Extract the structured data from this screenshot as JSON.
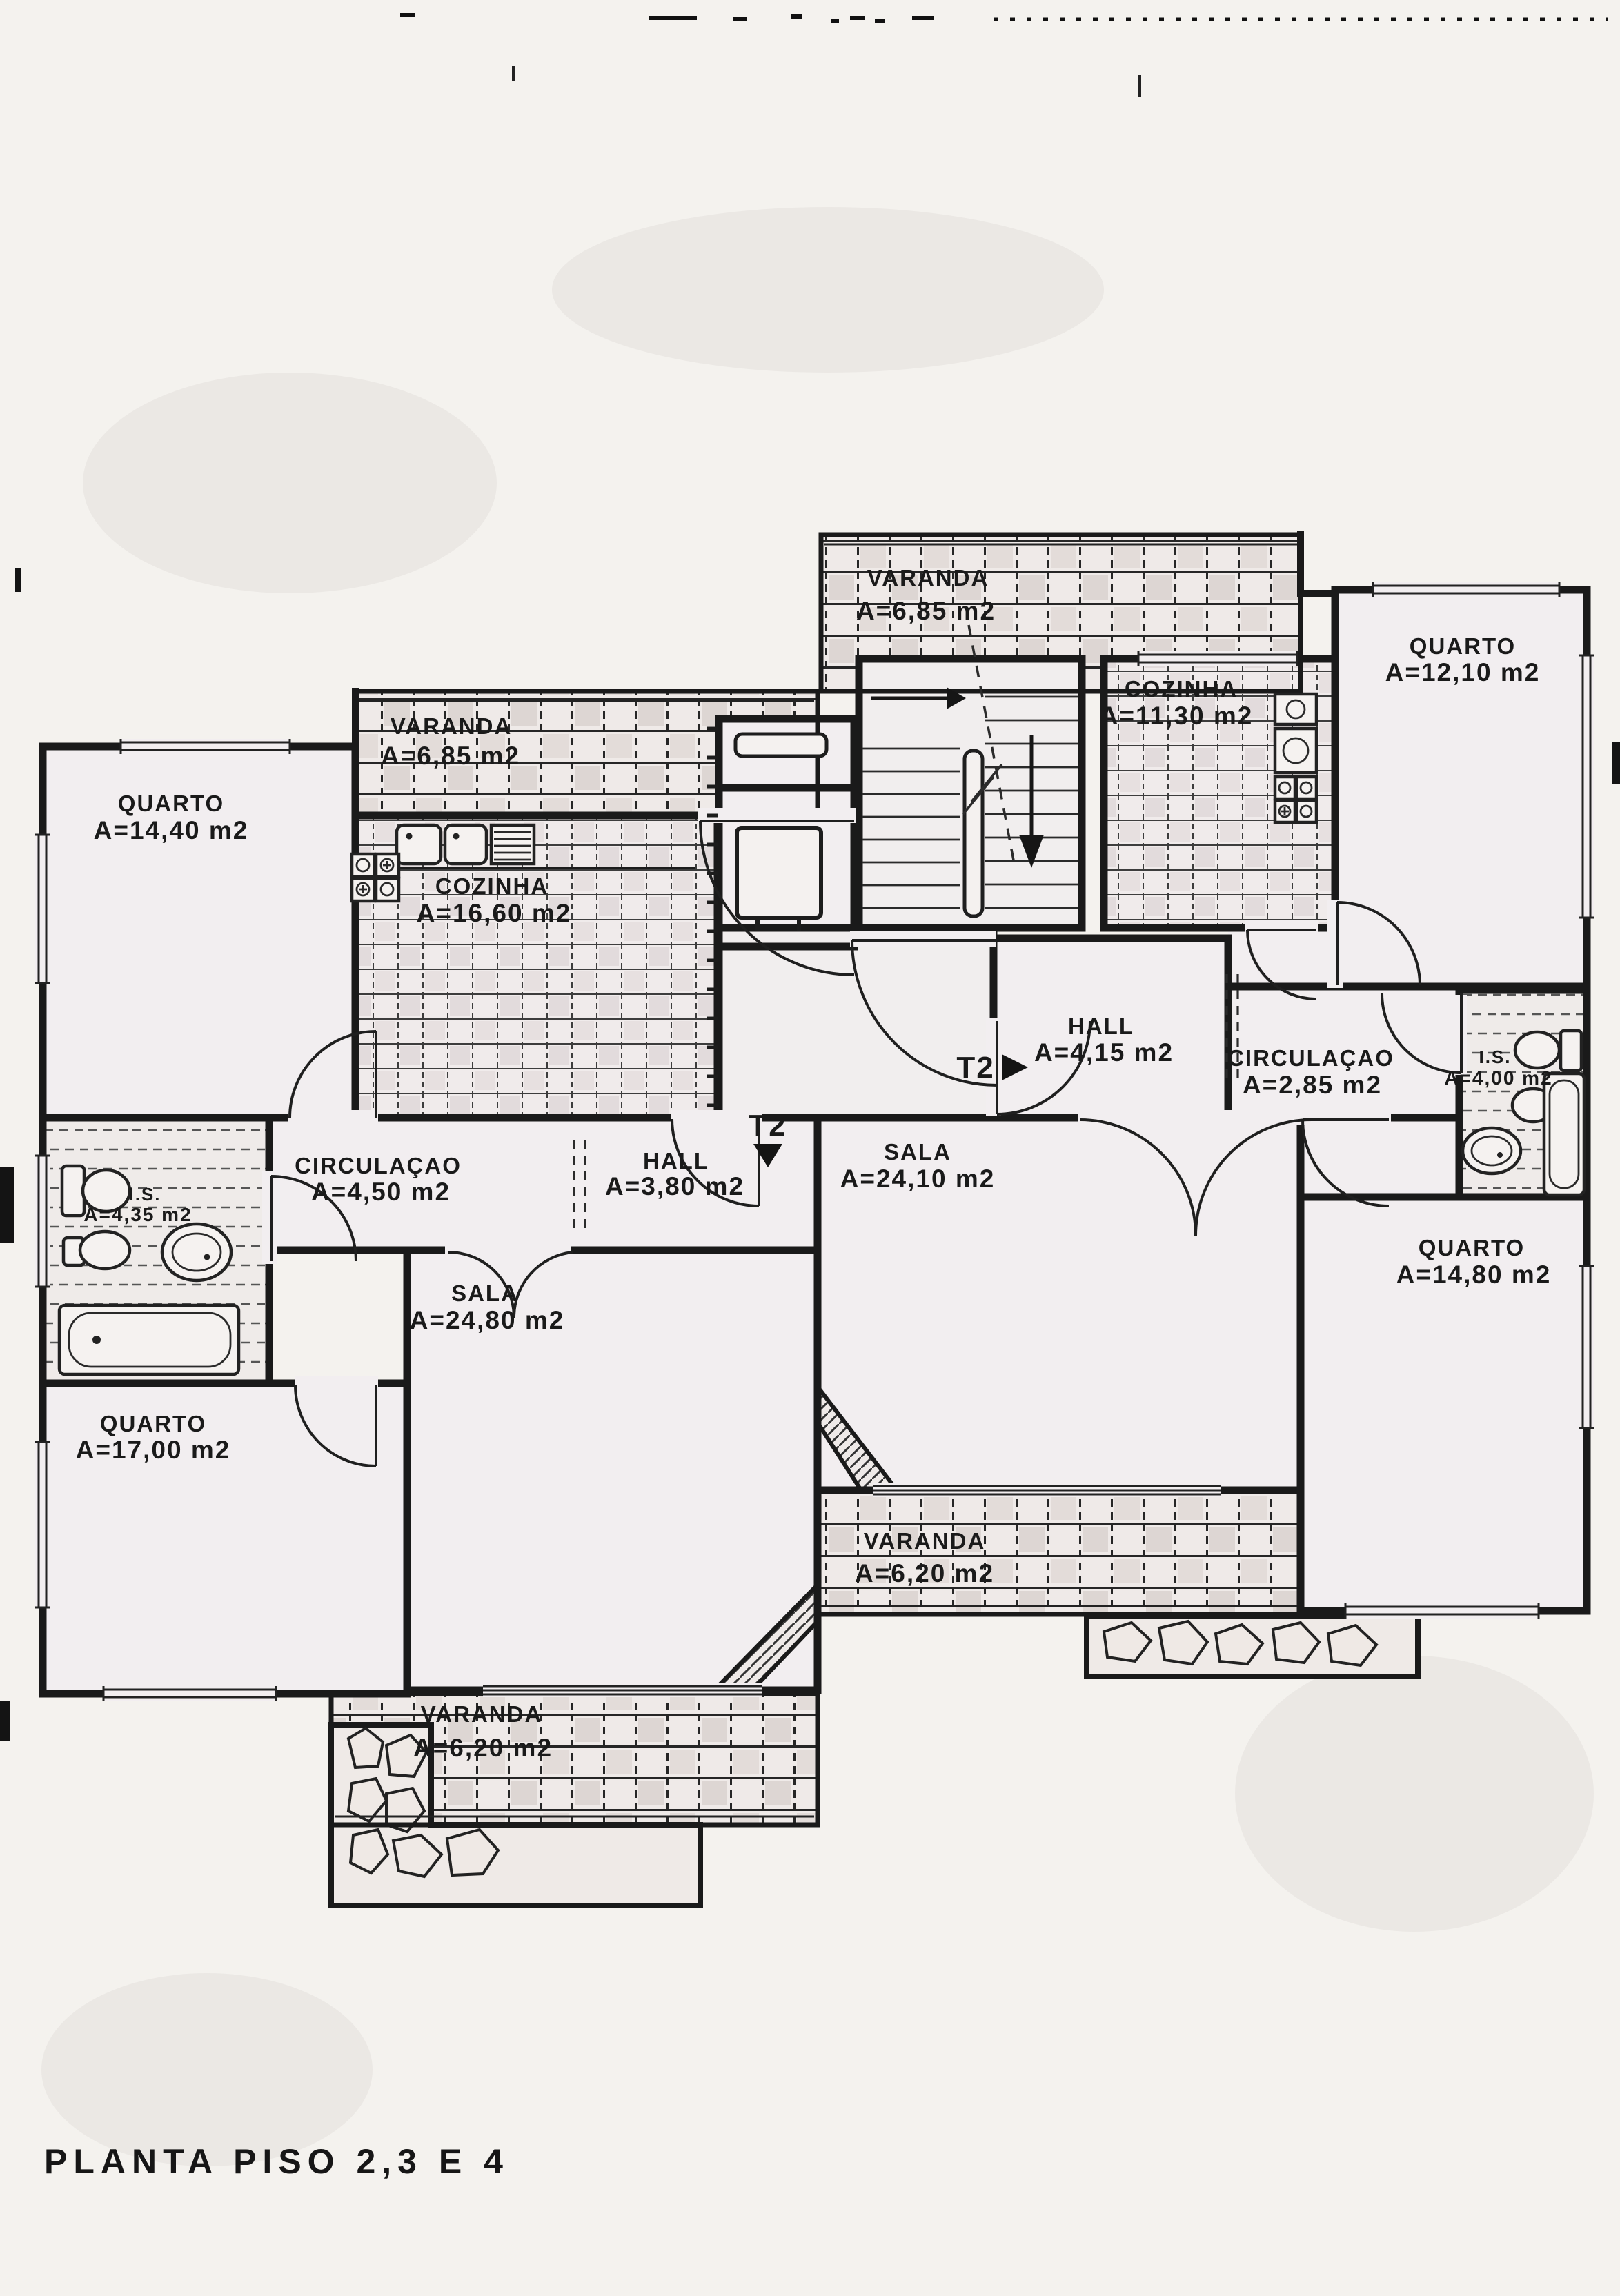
{
  "page": {
    "title": "PLANTA PISO 2,3 E 4"
  },
  "plan": {
    "colors": {
      "ink": "#1a1a1a",
      "paper": "#f4f2ee",
      "room": "#f2eef0",
      "shade": "#ded7d6"
    },
    "markers": {
      "t2_left": "T2",
      "t2_right": "T2"
    },
    "rooms": [
      {
        "id": "quarto-14-40",
        "name": "QUARTO",
        "area": "A=14,40 m2"
      },
      {
        "id": "varanda-6-85-left",
        "name": "VARANDA",
        "area": "A=6,85 m2"
      },
      {
        "id": "cozinha-16-60",
        "name": "COZINHA",
        "area": "A=16,60 m2"
      },
      {
        "id": "circulacao-4-50",
        "name": "CIRCULAÇAO",
        "area": "A=4,50 m2"
      },
      {
        "id": "hall-3-80",
        "name": "HALL",
        "area": "A=3,80 m2"
      },
      {
        "id": "is-4-35",
        "name": "I.S.",
        "area": "A=4,35 m2"
      },
      {
        "id": "quarto-17-00",
        "name": "QUARTO",
        "area": "A=17,00 m2"
      },
      {
        "id": "sala-24-80",
        "name": "SALA",
        "area": "A=24,80 m2"
      },
      {
        "id": "varanda-6-20-left",
        "name": "VARANDA",
        "area": "A=6,20 m2"
      },
      {
        "id": "varanda-6-85-top",
        "name": "VARANDA",
        "area": "A=6,85 m2"
      },
      {
        "id": "cozinha-11-30",
        "name": "COZINHA",
        "area": "A=11,30 m2"
      },
      {
        "id": "quarto-12-10",
        "name": "QUARTO",
        "area": "A=12,10 m2"
      },
      {
        "id": "hall-4-15",
        "name": "HALL",
        "area": "A=4,15 m2"
      },
      {
        "id": "circulacao-2-85",
        "name": "CIRCULAÇAO",
        "area": "A=2,85 m2"
      },
      {
        "id": "is-4-00",
        "name": "I.S.",
        "area": "A=4,00 m2"
      },
      {
        "id": "quarto-14-80",
        "name": "QUARTO",
        "area": "A=14,80 m2"
      },
      {
        "id": "sala-24-10",
        "name": "SALA",
        "area": "A=24,10 m2"
      },
      {
        "id": "varanda-6-20-center",
        "name": "VARANDA",
        "area": "A=6,20 m2"
      }
    ]
  }
}
